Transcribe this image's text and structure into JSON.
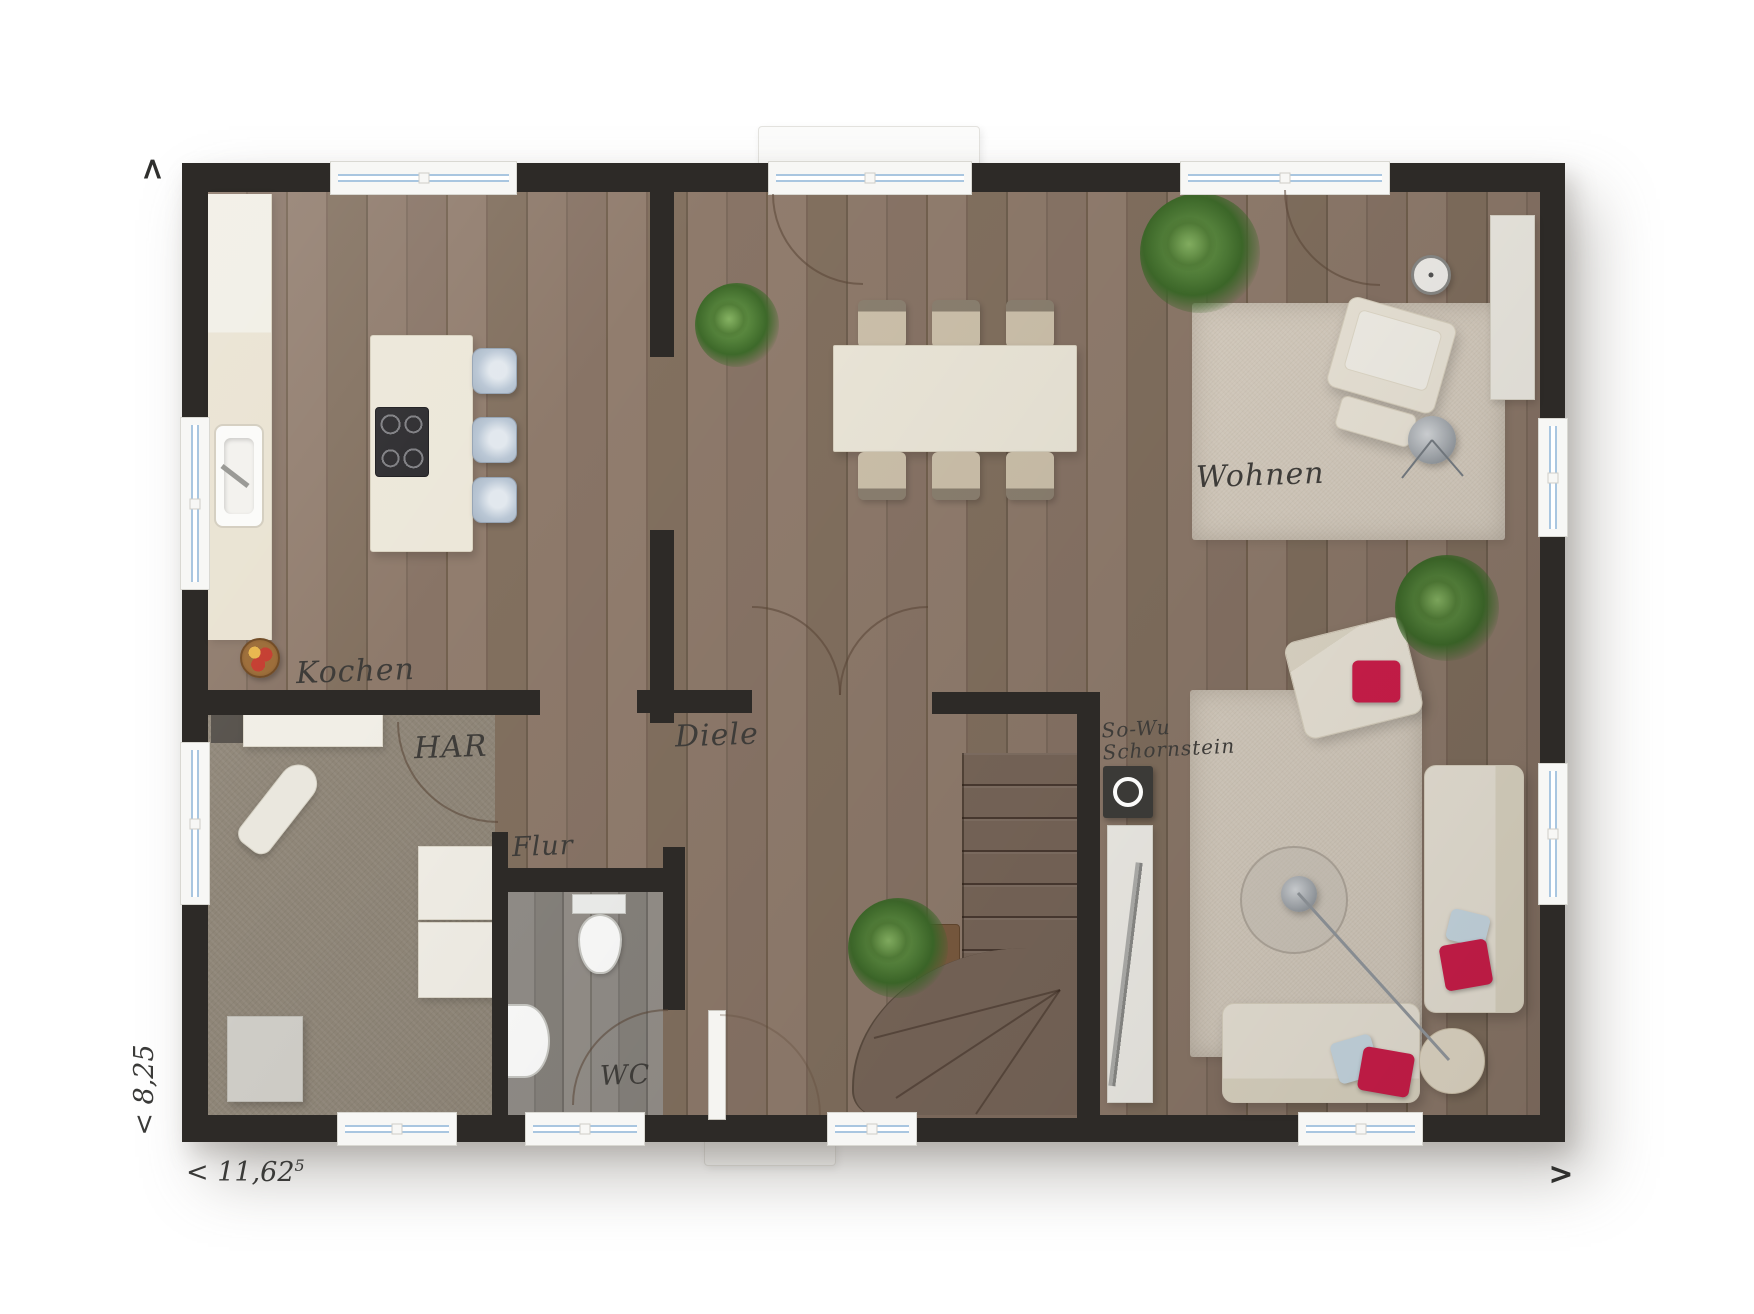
{
  "rooms": {
    "kochen": {
      "label": "Kochen"
    },
    "har": {
      "label": "HAR"
    },
    "flur": {
      "label": "Flur"
    },
    "diele": {
      "label": "Diele"
    },
    "wc": {
      "label": "WC"
    },
    "wohnen": {
      "label": "Wohnen"
    },
    "schornstein": {
      "line1": "So-Wu",
      "line2": "Schornstein"
    }
  },
  "dimensions": {
    "width": {
      "prefix": "<",
      "value": "11,62",
      "sup": "5"
    },
    "depth": {
      "text": "< 8,25"
    }
  },
  "nav": {
    "north": ">",
    "east": ">"
  },
  "colors": {
    "wall": "#2d2a27",
    "wood_floor": "#867263",
    "carpet": "#8f8678",
    "wc_floor": "#8b8781",
    "rug": "#d9cfc1",
    "kitchen_cream": "#ece7d9",
    "window_glass": "#a9c6e0",
    "pillow_red": "#d21e4c",
    "pillow_blue": "#cfe0ea",
    "plant_green": "#53813a",
    "stair_wood": "#79675a"
  }
}
